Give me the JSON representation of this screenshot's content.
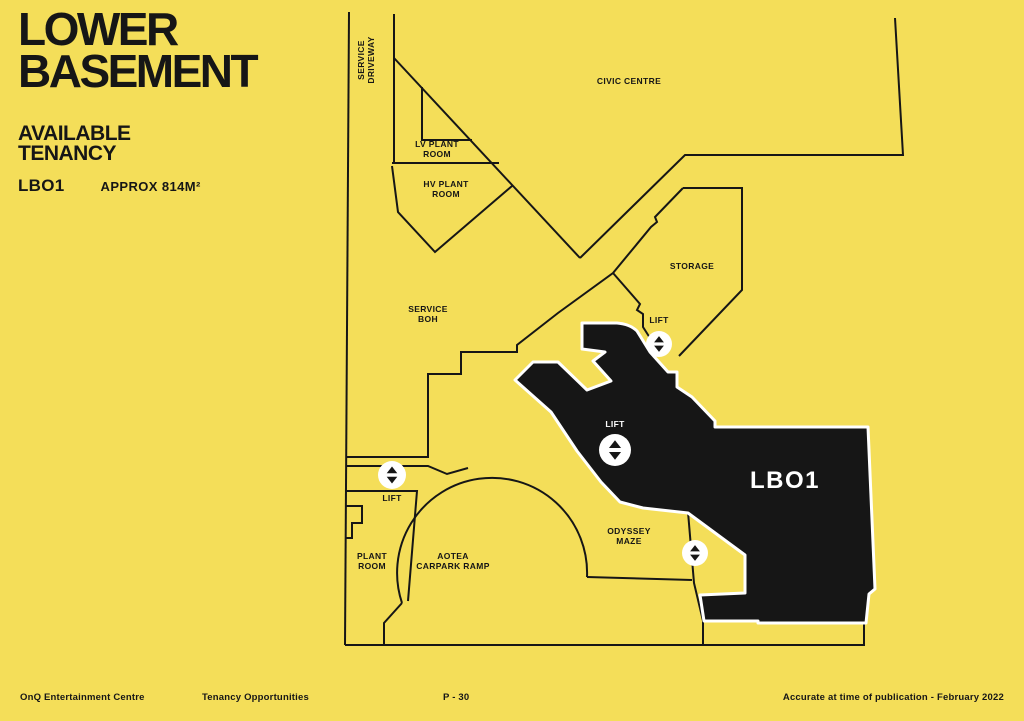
{
  "title": {
    "line1": "LOWER",
    "line2": "BASEMENT"
  },
  "subtitle": {
    "line1": "AVAILABLE",
    "line2": "TENANCY"
  },
  "tenancy": {
    "code": "LBO1",
    "area": "APPROX 814M²"
  },
  "plan": {
    "highlight_label": "LBO1",
    "labels": [
      {
        "id": "service-driveway",
        "lines": [
          "SERVICE",
          "DRIVEWAY"
        ],
        "x": 366,
        "y": 60,
        "rotate": -90,
        "color": "dark"
      },
      {
        "id": "civic-centre",
        "lines": [
          "CIVIC CENTRE"
        ],
        "x": 629,
        "y": 81,
        "color": "dark"
      },
      {
        "id": "lv-plant-room",
        "lines": [
          "LV PLANT",
          "ROOM"
        ],
        "x": 437,
        "y": 149,
        "color": "dark"
      },
      {
        "id": "hv-plant-room",
        "lines": [
          "HV PLANT",
          "ROOM"
        ],
        "x": 446,
        "y": 189,
        "color": "dark"
      },
      {
        "id": "storage",
        "lines": [
          "STORAGE"
        ],
        "x": 692,
        "y": 266,
        "color": "dark"
      },
      {
        "id": "service-boh",
        "lines": [
          "SERVICE",
          "BOH"
        ],
        "x": 428,
        "y": 314,
        "color": "dark"
      },
      {
        "id": "lift-storage",
        "lines": [
          "LIFT"
        ],
        "x": 659,
        "y": 320,
        "color": "dark"
      },
      {
        "id": "lift-central",
        "lines": [
          "LIFT"
        ],
        "x": 615,
        "y": 424,
        "color": "light"
      },
      {
        "id": "lbo1-area",
        "lines": [
          "LBO1"
        ],
        "x": 785,
        "y": 480,
        "color": "light",
        "size": 24,
        "spacing": 1.5,
        "dy": 8
      },
      {
        "id": "lift-west",
        "lines": [
          "LIFT"
        ],
        "x": 392,
        "y": 498,
        "color": "dark"
      },
      {
        "id": "odyssey-maze",
        "lines": [
          "ODYSSEY",
          "MAZE"
        ],
        "x": 629,
        "y": 536,
        "color": "dark"
      },
      {
        "id": "plant-room",
        "lines": [
          "PLANT",
          "ROOM"
        ],
        "x": 372,
        "y": 561,
        "color": "dark"
      },
      {
        "id": "aotea-carpark-ramp",
        "lines": [
          "AOTEA",
          "CARPARK RAMP"
        ],
        "x": 453,
        "y": 561,
        "color": "dark"
      }
    ],
    "lifts": [
      {
        "id": "lift-icon-storage",
        "x": 659,
        "y": 344,
        "r": 13
      },
      {
        "id": "lift-icon-central",
        "x": 615,
        "y": 450,
        "r": 16
      },
      {
        "id": "lift-icon-west",
        "x": 392,
        "y": 475,
        "r": 14
      },
      {
        "id": "lift-icon-odyssey",
        "x": 695,
        "y": 553,
        "r": 13
      }
    ]
  },
  "footer": {
    "left": "OnQ Entertainment Centre",
    "tenancy": "Tenancy Opportunities",
    "page": "P - 30",
    "right": "Accurate at time of publication - February 2022"
  },
  "colors": {
    "background": "#F4DE59",
    "ink": "#161616",
    "highlight": "#161616",
    "lift_circle": "#FFFFFF",
    "light_text": "#FFFFFF"
  }
}
